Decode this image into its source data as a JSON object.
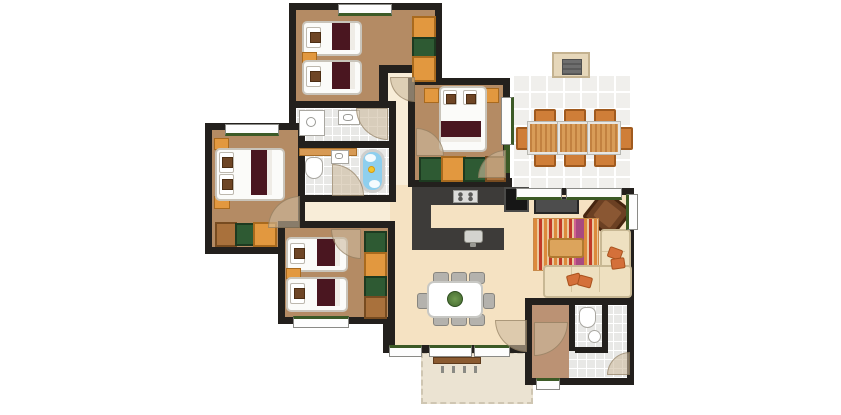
{
  "meta": {
    "title": "Holiday lodge floor plan",
    "type": "architectural top-down floor plan",
    "canvas": {
      "width": 841,
      "height": 415
    }
  },
  "palette": {
    "wall": "#23201d",
    "bedroom_floor": "#b48b64",
    "living_floor": "#f5e2c2",
    "hall_floor": "#f8edd8",
    "entry_hall_floor": "#bb9274",
    "bathroom_tile": "#e8e8e6",
    "terrace_tile": "#f0efec",
    "garden_terrace": "#ebe3d2",
    "window_sill_green": "#3c5a26",
    "blanket_maroon": "#4a1620",
    "furniture_orange": "#e2983f",
    "wardrobe_green": "#2e5a33",
    "wardrobe_brown": "#a9713c",
    "kitchen_counter": "#3d3b39",
    "bath_water_blue": "#8ecfee",
    "rug_orange": "#dd8a3c",
    "rug_red": "#c23a28",
    "rug_purple": "#a84a80",
    "sofa_cream": "#eee0c0",
    "cushion_orange": "#d4703a",
    "armchair_brown": "#6b4023",
    "outdoor_wood": "#cb8d4a"
  },
  "rooms": {
    "bedroom_top": {
      "label": "Twin bedroom (two single beds)"
    },
    "bedroom_left": {
      "label": "Double bedroom"
    },
    "bedroom_bottom_left": {
      "label": "Twin bedroom (two single beds)"
    },
    "bedroom_middle": {
      "label": "Double bedroom"
    },
    "shower_room": {
      "label": "Shower room with washbasin"
    },
    "bathroom": {
      "label": "Bathroom with bathtub, toilet and washbasin"
    },
    "toilet_room": {
      "label": "Separate WC"
    },
    "entrance_hall": {
      "label": "Entrance hall"
    },
    "inner_hall": {
      "label": "Hallway"
    },
    "living_area": {
      "label": "Open-plan living area"
    },
    "kitchen": {
      "label": "Kitchen"
    },
    "dining_terrace": {
      "label": "Outdoor dining terrace with barbecue"
    },
    "garden_terrace": {
      "label": "Garden terrace with bench"
    }
  },
  "furniture": {
    "single_bed": {
      "label": "Single bed"
    },
    "double_bed": {
      "label": "Double bed"
    },
    "wardrobe": {
      "label": "Wardrobe unit"
    },
    "bathtub": {
      "label": "Bathtub"
    },
    "rubber_duck": {
      "label": "Rubber duck"
    },
    "shower": {
      "label": "Shower"
    },
    "toilet": {
      "label": "Toilet"
    },
    "washbasin": {
      "label": "Washbasin"
    },
    "stove": {
      "label": "Cooktop"
    },
    "kitchen_sink": {
      "label": "Kitchen sink"
    },
    "refrigerator": {
      "label": "Refrigerator"
    },
    "dining_table_indoor": {
      "label": "Indoor dining table with 8 chairs and plant"
    },
    "dining_table_outdoor": {
      "label": "Outdoor dining table with 8 chairs"
    },
    "barbecue": {
      "label": "Barbecue / fireplace"
    },
    "tv": {
      "label": "Television"
    },
    "rug": {
      "label": "Striped rug"
    },
    "coffee_table": {
      "label": "Coffee table"
    },
    "sofa": {
      "label": "Corner sofa"
    },
    "armchair": {
      "label": "Armchair"
    },
    "bench": {
      "label": "Garden bench"
    }
  }
}
